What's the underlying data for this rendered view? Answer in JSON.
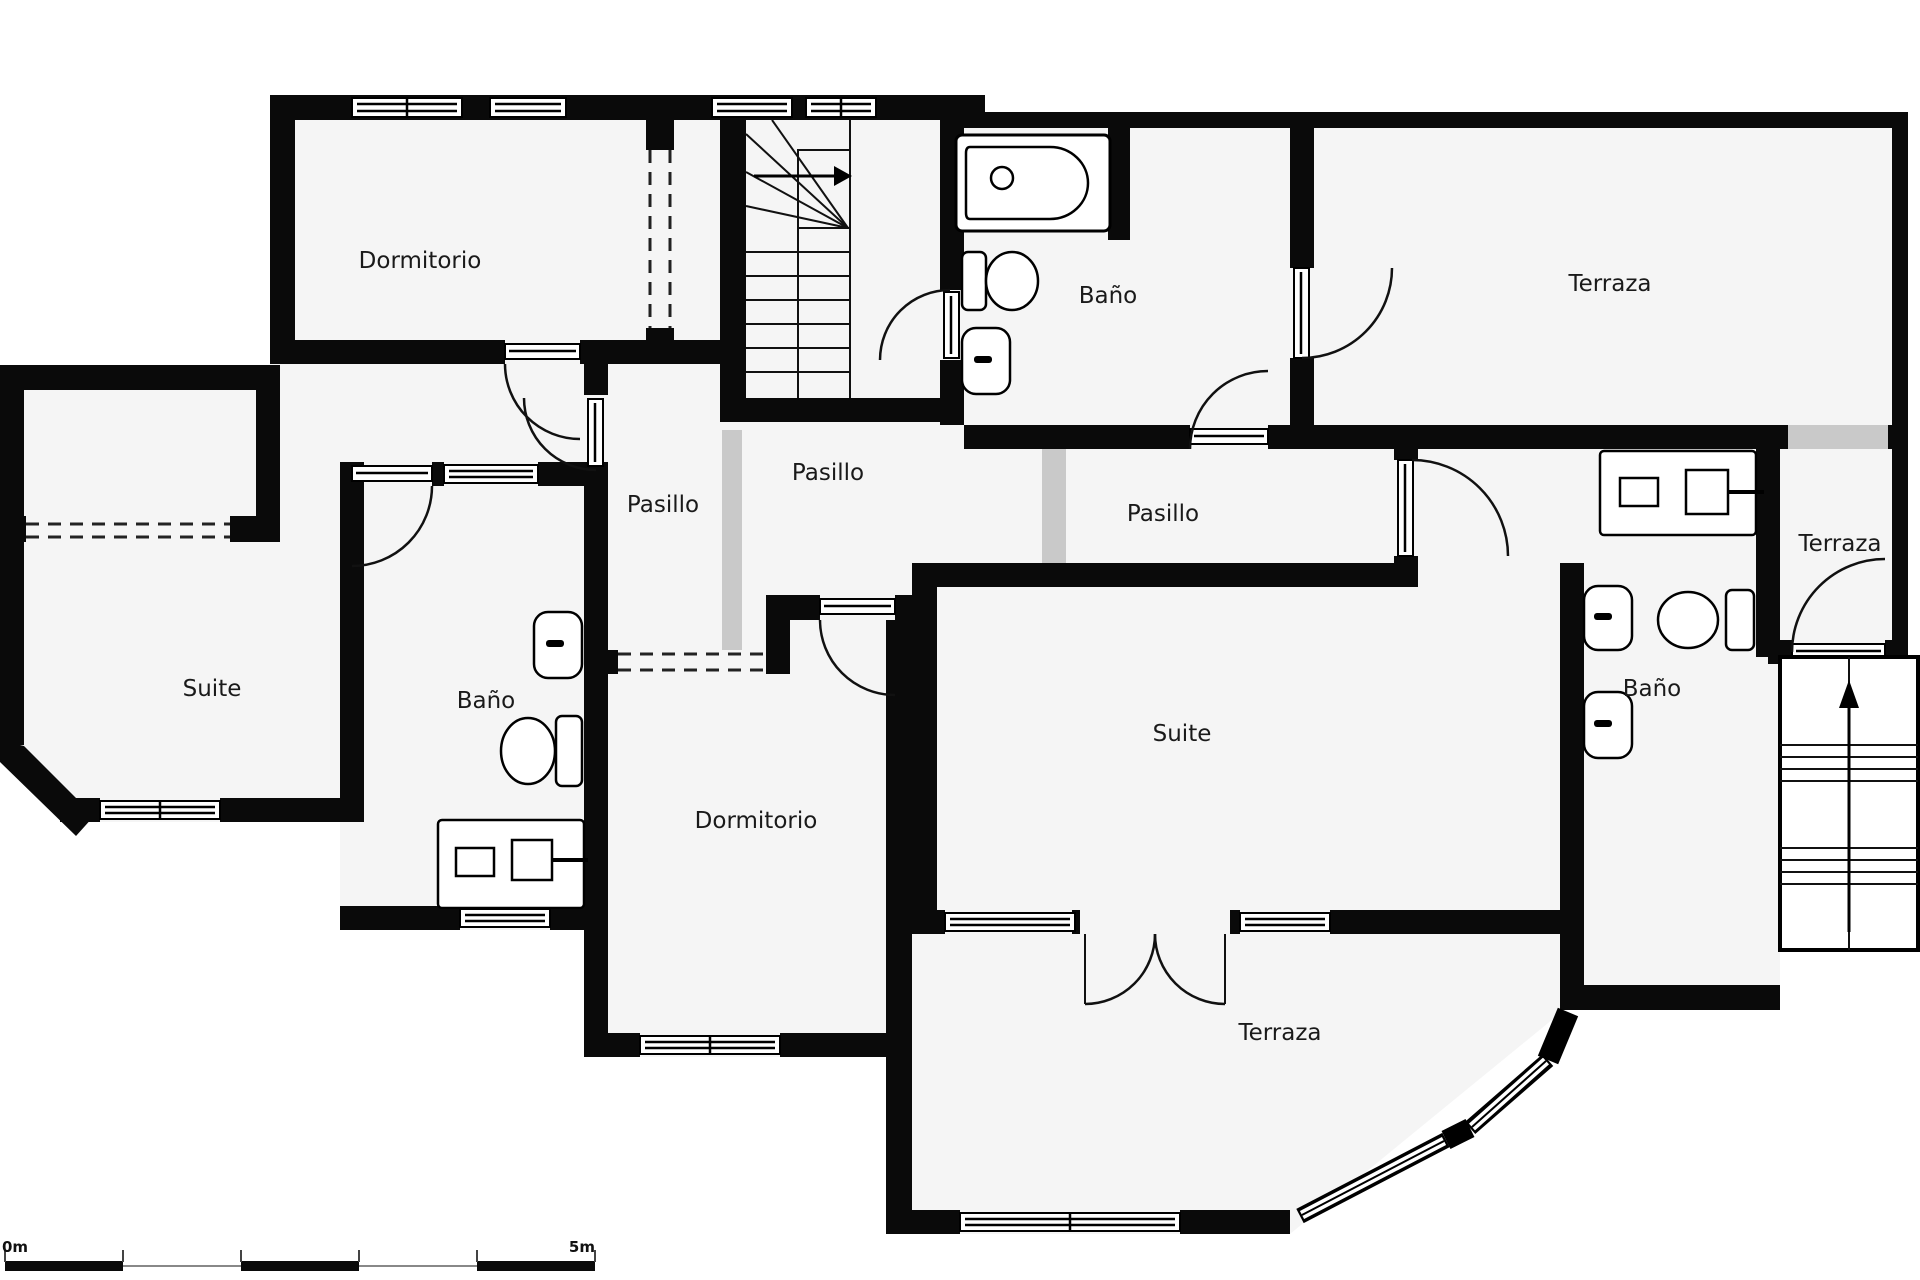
{
  "plan": {
    "type": "floor-plan",
    "language": "es",
    "rooms": [
      {
        "id": "dormitorio-nw",
        "label": "Dormitorio"
      },
      {
        "id": "bano-top",
        "label": "Baño"
      },
      {
        "id": "terraza-top",
        "label": "Terraza"
      },
      {
        "id": "pasillo-left",
        "label": "Pasillo"
      },
      {
        "id": "pasillo-center",
        "label": "Pasillo"
      },
      {
        "id": "pasillo-right",
        "label": "Pasillo"
      },
      {
        "id": "suite-left",
        "label": "Suite"
      },
      {
        "id": "bano-left",
        "label": "Baño"
      },
      {
        "id": "dormitorio-center",
        "label": "Dormitorio"
      },
      {
        "id": "suite-right",
        "label": "Suite"
      },
      {
        "id": "bano-right",
        "label": "Baño"
      },
      {
        "id": "terraza-right",
        "label": "Terraza"
      },
      {
        "id": "terraza-bottom",
        "label": "Terraza"
      }
    ],
    "scale_bar": {
      "start_label": "0m",
      "end_label": "5m"
    },
    "colors": {
      "wall": "#0a0a0a",
      "floor": "#f5f5f5",
      "opening_gap": "#c9c9c9",
      "background": "#ffffff"
    }
  }
}
